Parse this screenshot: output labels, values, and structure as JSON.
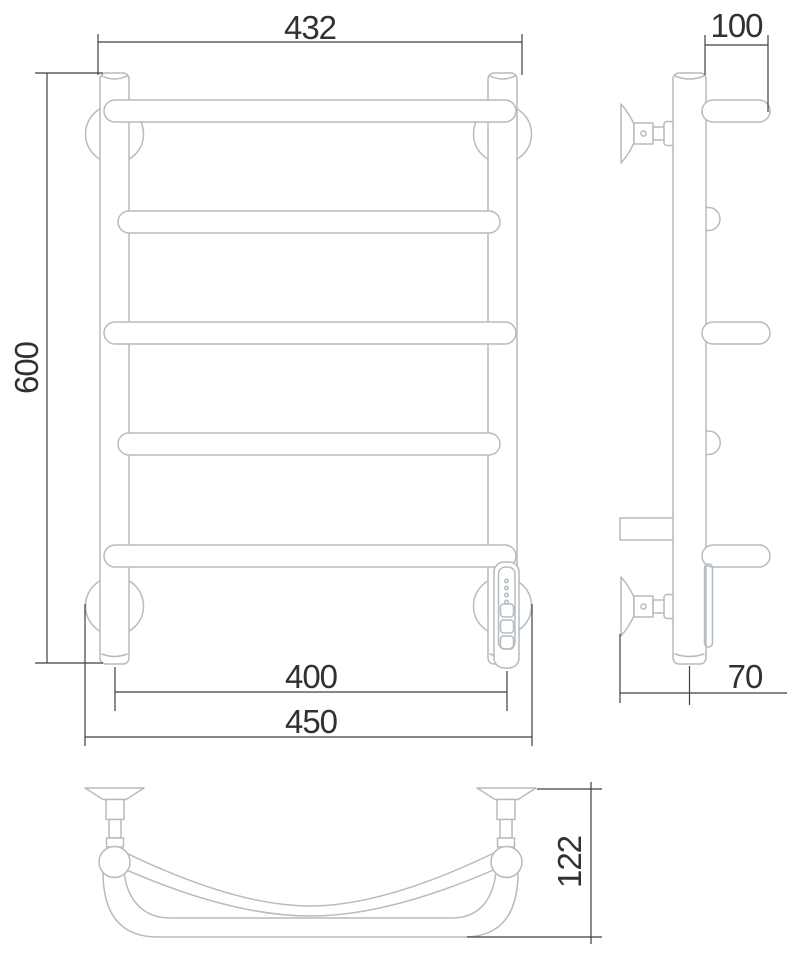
{
  "drawing": {
    "colors": {
      "outline": "#b3bcc1",
      "dimension_line": "#3b4144",
      "text": "#2e3234",
      "background": "#ffffff"
    },
    "front_view": {
      "dim_top_width": "432",
      "dim_height": "600",
      "dim_bottom_inner_width": "400",
      "dim_bottom_outer_width": "450"
    },
    "side_view": {
      "dim_top_depth": "100",
      "dim_bottom_wall_offset": "70"
    },
    "plan_view": {
      "dim_depth": "122"
    }
  }
}
